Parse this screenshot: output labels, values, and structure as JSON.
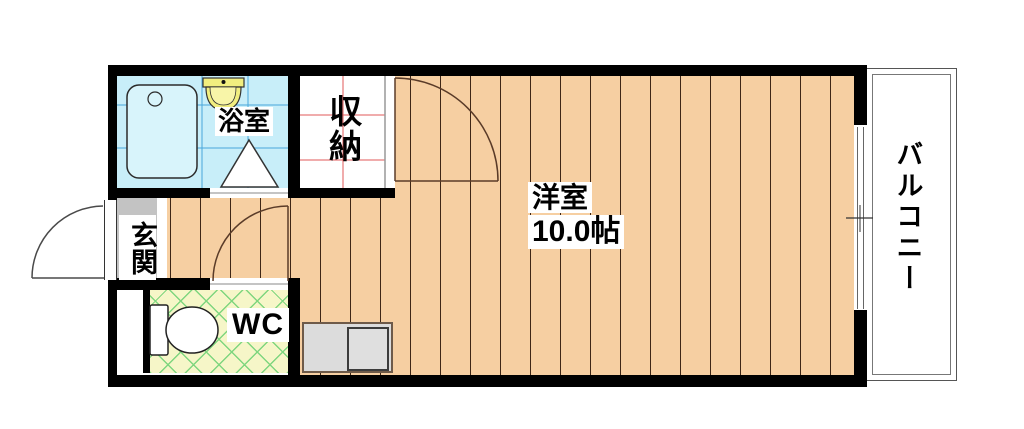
{
  "rooms": {
    "bathroom": {
      "label": "浴室"
    },
    "closet": {
      "label": "収納"
    },
    "entrance": {
      "label": "玄関"
    },
    "wc": {
      "label": "WC"
    },
    "main": {
      "label": "洋室",
      "size": "10.0帖"
    },
    "balcony": {
      "label": "バルコニー"
    }
  },
  "colors": {
    "wall": "#000000",
    "wood_floor": "#f6cfa2",
    "wood_floor_line": "#3e2616",
    "bathroom_floor": "#c8eef9",
    "bathroom_tile_line": "#49a7dc",
    "wc_floor": "#f6f6c8",
    "wc_lattice": "#7fd67f",
    "entrance_floor": "#c3c3c3",
    "fixture_yellow": "#f1ee7f",
    "closet_grid": "#e05a5a",
    "appliance_gray": "#dcdcdc"
  }
}
